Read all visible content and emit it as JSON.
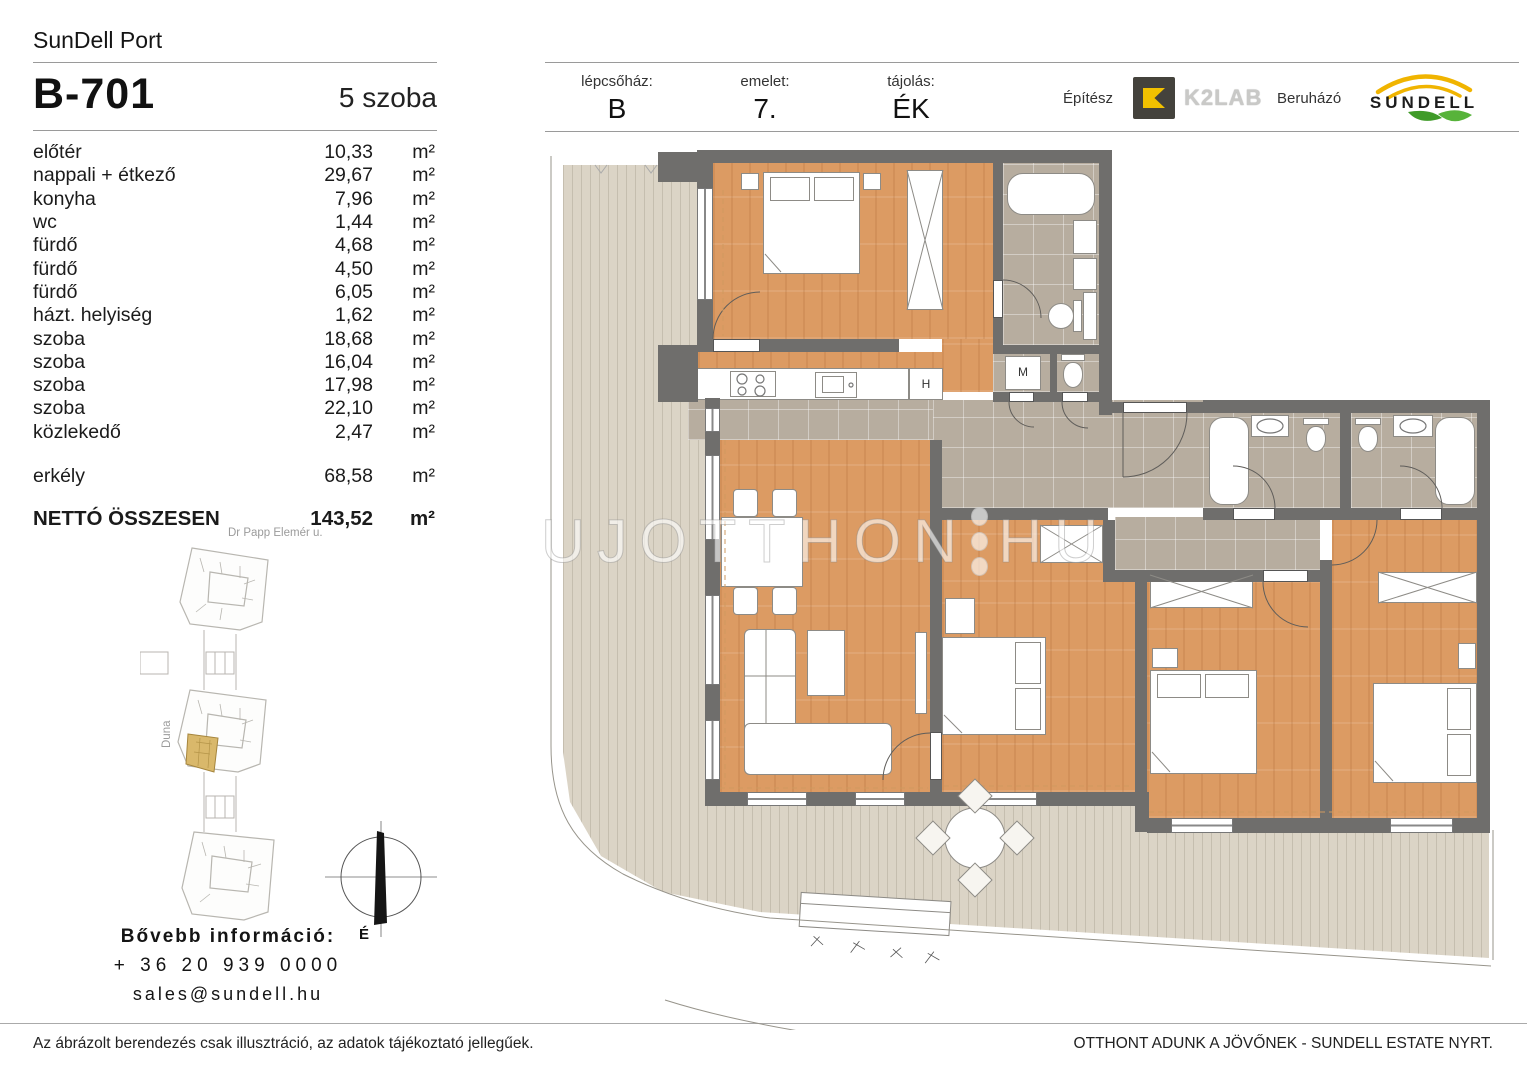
{
  "brand": "SunDell Port",
  "unit": {
    "id": "B-701",
    "rooms_label": "5 szoba"
  },
  "header_info": {
    "staircase_label": "lépcsőház:",
    "staircase_value": "B",
    "floor_label": "emelet:",
    "floor_value": "7.",
    "orientation_label": "tájolás:",
    "orientation_value": "ÉK"
  },
  "partners": {
    "architect_label": "Építész",
    "architect_name": "K2LAB",
    "developer_label": "Beruházó",
    "developer_name": "SUNDELL"
  },
  "table": {
    "unit": "m²",
    "rows": [
      {
        "name": "előtér",
        "area": "10,33"
      },
      {
        "name": "nappali + étkező",
        "area": "29,67"
      },
      {
        "name": "konyha",
        "area": "7,96"
      },
      {
        "name": "wc",
        "area": "1,44"
      },
      {
        "name": "fürdő",
        "area": "4,68"
      },
      {
        "name": "fürdő",
        "area": "4,50"
      },
      {
        "name": "fürdő",
        "area": "6,05"
      },
      {
        "name": "házt. helyiség",
        "area": "1,62"
      },
      {
        "name": "szoba",
        "area": "18,68"
      },
      {
        "name": "szoba",
        "area": "16,04"
      },
      {
        "name": "szoba",
        "area": "17,98"
      },
      {
        "name": "szoba",
        "area": "22,10"
      },
      {
        "name": "közlekedő",
        "area": "2,47"
      }
    ],
    "balcony": {
      "name": "erkély",
      "area": "68,58"
    },
    "total": {
      "label": "NETTÓ ÖSSZESEN",
      "area": "143,52"
    }
  },
  "sitemap": {
    "street": "Dr Papp Elemér u.",
    "river": "Duna",
    "compass": "É"
  },
  "contact": {
    "title": "Bővebb információ:",
    "phone": "+ 36 20 939 0000",
    "email": "sales@sundell.hu"
  },
  "footer": {
    "disclaimer": "Az ábrázolt berendezés csak illusztráció, az adatok tájékoztató jellegűek.",
    "slogan": "OTTHONT ADUNK A JÖVŐNEK - SUNDELL ESTATE NYRT."
  },
  "watermark": {
    "part1": "UJOTTHON",
    "part2": "HU"
  },
  "plan_labels": {
    "washing_machine": "M",
    "fridge": "H"
  },
  "colors": {
    "accent_yellow": "#f2c100",
    "leaf_green": "#4aa32e",
    "wood": "#dc9b63",
    "tile": "#b7ad9f",
    "wall": "#6f6e6c",
    "terrace": "#dbd4c6",
    "highlight": "#d9b86b"
  }
}
